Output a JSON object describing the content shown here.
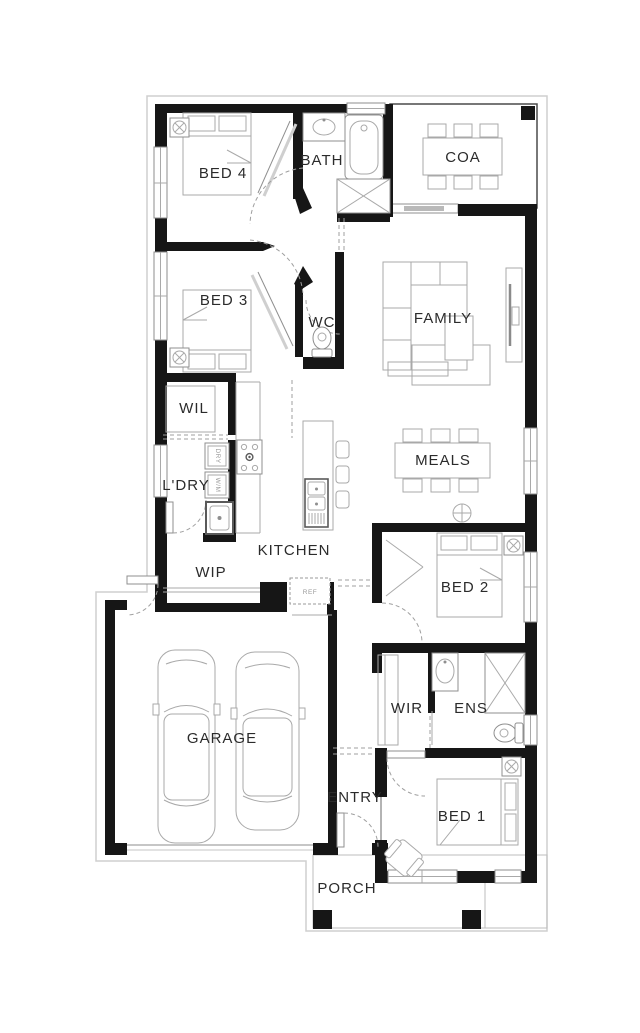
{
  "plan": {
    "title": "single-storey house floor plan",
    "colors": {
      "wall": "#161616",
      "furniture_line": "#a9a9a9",
      "dash_line": "#9f9f9f",
      "label_text": "#2b2b2b",
      "eave_line": "#cfcfcf",
      "background": "#ffffff"
    },
    "rooms": {
      "bed4": "BED 4",
      "bath": "BATH",
      "coa": "COA",
      "bed3": "BED 3",
      "wc": "WC",
      "family": "FAMILY",
      "wil": "WIL",
      "meals": "MEALS",
      "ldry": "L'DRY",
      "kitchen": "KITCHEN",
      "wip": "WIP",
      "bed2": "BED 2",
      "garage": "GARAGE",
      "wir": "WIR",
      "ens": "ENS",
      "entry": "ENTRY",
      "bed1": "BED 1",
      "porch": "PORCH"
    },
    "appliances": {
      "dryer": "DRY",
      "washer": "W/M",
      "fridge": "REF"
    },
    "icons": [
      "ceiling-fan-icon",
      "light-icon",
      "toilet-icon",
      "bathtub-icon",
      "shower-icon",
      "basin-icon",
      "sink-icon",
      "cooktop-icon",
      "bed-icon",
      "sofa-icon",
      "tv-icon",
      "dining-table-icon",
      "car-icon",
      "armchair-icon",
      "door-swing-icon",
      "window-icon"
    ]
  }
}
